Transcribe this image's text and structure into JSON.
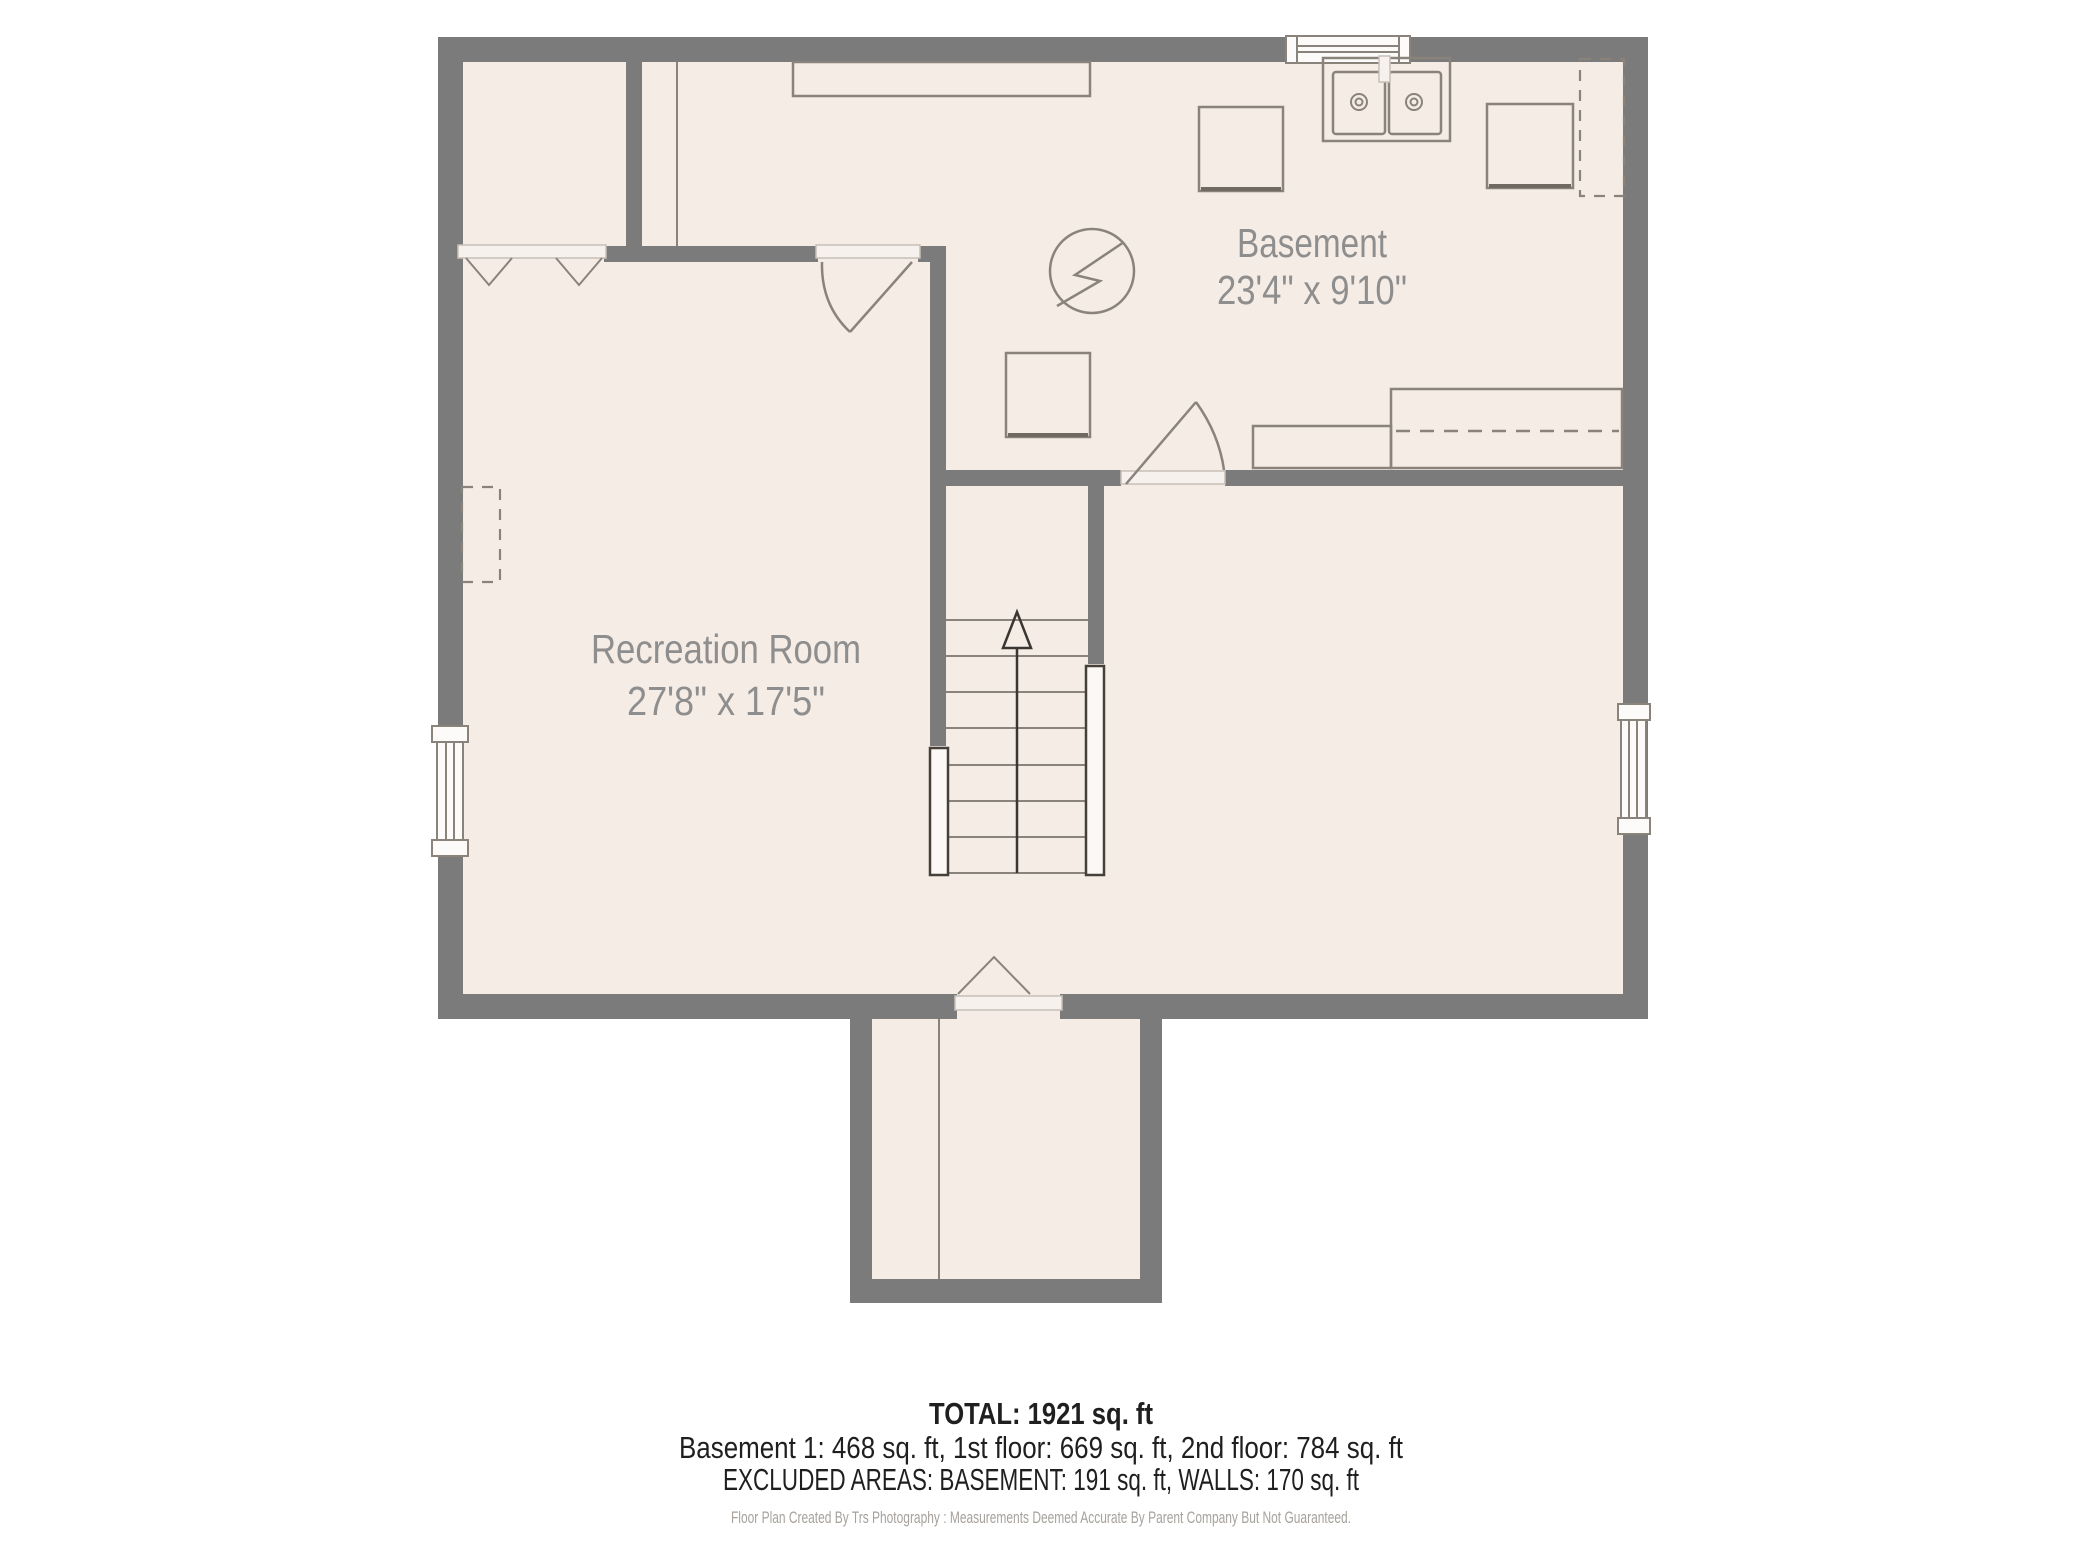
{
  "rooms": [
    {
      "name": "Basement",
      "dimensions": "23'4\" x 9'10\""
    },
    {
      "name": "Recreation Room",
      "dimensions": "27'8\" x 17'5\""
    }
  ],
  "stairs": {
    "direction": "up"
  },
  "icons": {
    "electrical_panel": "circle-lightning-bolt",
    "laundry_sink": "double-basin-sink",
    "stairs_arrow": "up-arrow"
  },
  "summary": {
    "total": "TOTAL: 1921 sq. ft",
    "floors": "Basement 1: 468 sq. ft, 1st floor: 669 sq. ft, 2nd floor: 784 sq. ft",
    "excluded": "EXCLUDED AREAS: BASEMENT: 191 sq. ft, WALLS: 170 sq. ft"
  },
  "attribution": "Floor Plan Created By Trs Photography : Measurements Deemed Accurate By Parent Company But Not Guaranteed.",
  "colors": {
    "wall": "#7b7b7b",
    "floor": "#f5ece5",
    "line": "#8a837c",
    "room_label": "#8e8e8e",
    "summary_text": "#1f1f1f",
    "attribution_text": "#a6a19c",
    "background": "#ffffff"
  }
}
